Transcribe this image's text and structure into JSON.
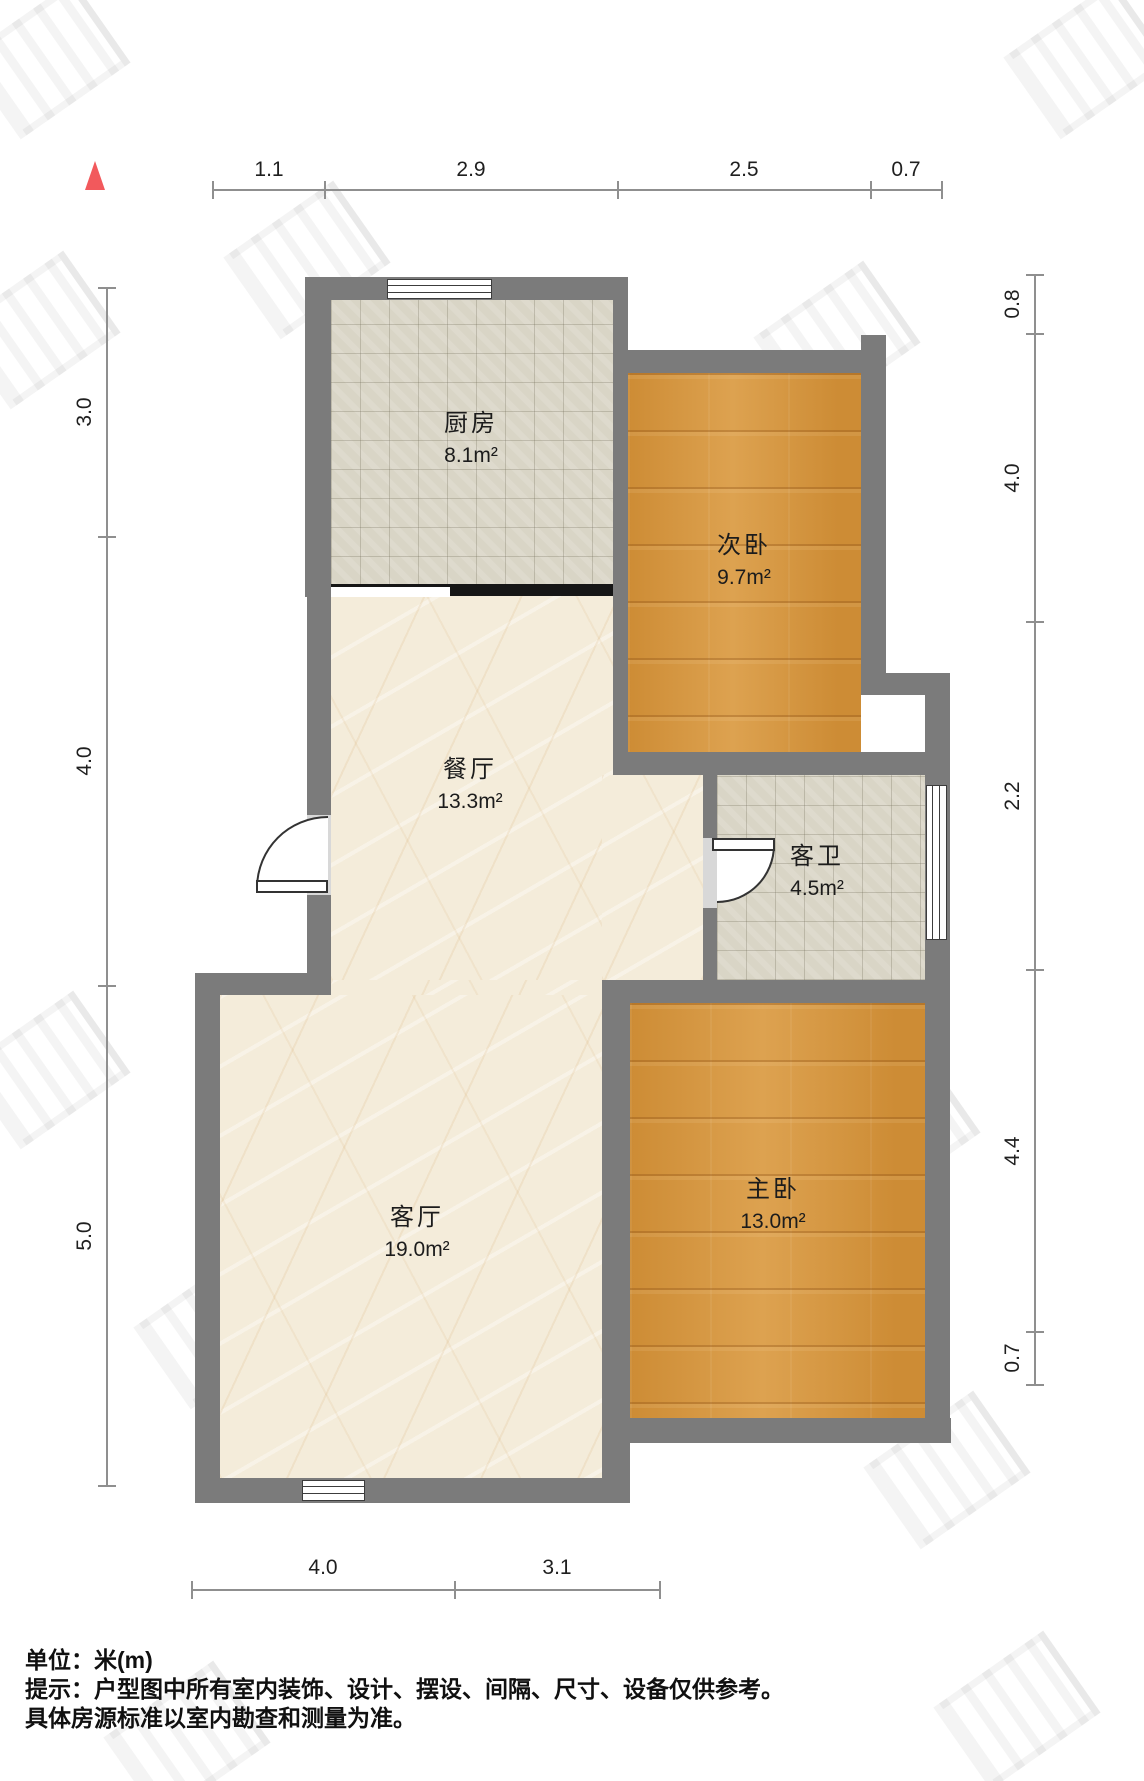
{
  "plan": {
    "unit_scale_note": "floor plan drawing",
    "north_color": "#f2595c"
  },
  "dimensions": {
    "top": [
      "1.1",
      "2.9",
      "2.5",
      "0.7"
    ],
    "left": [
      "3.0",
      "4.0",
      "5.0"
    ],
    "right": [
      "0.8",
      "4.0",
      "2.2",
      "4.4",
      "0.7"
    ],
    "bottom": [
      "4.0",
      "3.1"
    ]
  },
  "rooms": [
    {
      "name": "厨房",
      "area": "8.1m²"
    },
    {
      "name": "次卧",
      "area": "9.7m²"
    },
    {
      "name": "餐厅",
      "area": "13.3m²"
    },
    {
      "name": "客卫",
      "area": "4.5m²"
    },
    {
      "name": "客厅",
      "area": "19.0m²"
    },
    {
      "name": "主卧",
      "area": "13.0m²"
    }
  ],
  "footer": {
    "line1": "单位：米(m)",
    "line2": "提示：户型图中所有室内装饰、设计、摆设、间隔、尺寸、设备仅供参考。",
    "line3": "具体房源标准以室内勘查和测量为准。"
  },
  "colors": {
    "wall": "#7b7b7b",
    "wood_floor": "#d2923c",
    "tile_floor": "#d9d5c6",
    "marble_floor": "#f4ecda",
    "dimension_line": "#8f8f8f"
  }
}
